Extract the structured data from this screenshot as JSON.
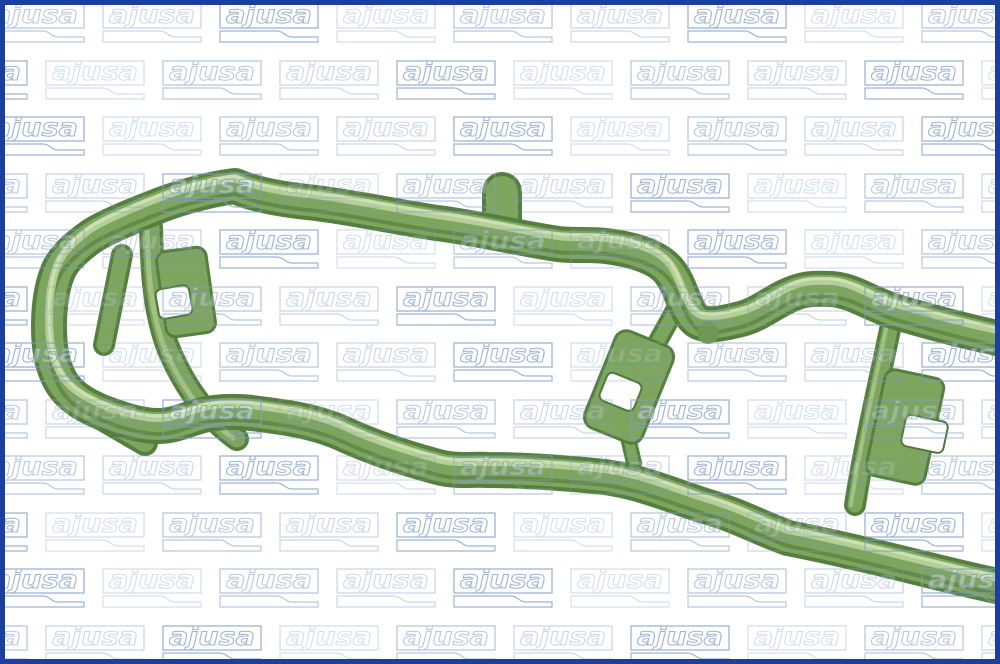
{
  "canvas": {
    "width": 1000,
    "height": 664,
    "background": "#ffffff"
  },
  "border": {
    "color": "#1a3f9f",
    "width_px": 5
  },
  "watermark": {
    "text": "ajusa",
    "stroke_color": "#7f9cc6",
    "letter_fill": "rgba(255,255,255,0.45)",
    "tile_width": 100,
    "tile_height": 40,
    "x_period": 117,
    "y_period": 56.5,
    "rows": 12,
    "cols_from": -1,
    "cols_to": 8,
    "even_row_x_offset": -20,
    "odd_row_x_offset": 40,
    "first_row_y": -2,
    "opacities": [
      0.75,
      0.4,
      0.55,
      0.32
    ],
    "box": {
      "x": 1,
      "y": 1,
      "w": 98,
      "h": 24,
      "stroke_w": 1.3
    },
    "swoosh_path": "M1,28 L58,28 C65,28 66,34 73,34 L99,34 L99,39 L1,39 Z",
    "text_x": 7,
    "text_y": 20,
    "font_size": 25,
    "text_length": 86
  },
  "gasket": {
    "description": "green molded silicone manifold gasket photographed diagonally, left end loop with inner bars and notched tabs, rails running off the right edge",
    "colors": {
      "base": "#7ea55d",
      "edge_dark": "#567f3f",
      "shadow_dark": "#4a7034",
      "highlight": "#b7d29a",
      "highlight_bright": "#d3e4bd",
      "bar_highlight": "#a6c487",
      "nub": "#6f9854",
      "notch_fill": "#fcfdfc",
      "notch_stroke": "#50783a"
    },
    "paths": {
      "frame": "M1016,338 C975,330 925,317 888,306 C862,297 846,285 826,284 C806,283 796,284 780,292 C764,300 752,310 736,314 C720,318 700,323 691,315 C678,303 677,282 664,266 C652,251 625,244 601,241 C584,239 567,241 553,239 C518,234 472,223 432,218 C396,213 342,201 302,197 C274,194 248,189 230,181 C198,185 165,196 148,203 C115,216 95,225 84,233 C68,245 57,255 52,269 C46,285 44,302 44,321 C44,344 47,358 53,371 C61,389 77,399 96,407 C117,415 136,421 153,421 C172,421 186,412 203,409 C230,404 255,409 283,413 C306,417 324,422 343,431 C372,444 407,455 433,462 C452,467 466,464 483,465 C520,465 560,468 600,472 C640,478 665,490 700,501 C740,513 745,519 783,533 C824,541 858,549 903,560 C940,569 975,578 1016,586",
      "frame_bump": "M75,400 L140,438",
      "bar_long": "M146,222 C147,260 148,300 162,340 C180,385 205,415 232,434",
      "bar_short": "M117,250 L99,340",
      "strut_mid": "M674,297 C664,318 650,340 641,358",
      "strut_mid2": "M622,428 L629,458",
      "strut_right": "M889,305 C877,365 860,435 850,500",
      "top_tab": "M497,213 L497,187"
    },
    "tabs": [
      {
        "x": 156,
        "y": 244,
        "w": 50,
        "h": 86,
        "rx": 10,
        "rotate": "-8 181 287"
      },
      {
        "x": 593,
        "y": 330,
        "w": 62,
        "h": 104,
        "rx": 12,
        "rotate": "22 624 382"
      },
      {
        "x": 870,
        "y": 368,
        "w": 60,
        "h": 108,
        "rx": 10,
        "rotate": "12 900 422"
      }
    ],
    "notches": [
      {
        "x": 152,
        "y": 282,
        "w": 34,
        "h": 30,
        "rx": 6,
        "rotate": "-10 169 297"
      },
      {
        "x": 597,
        "y": 372,
        "w": 37,
        "h": 30,
        "rx": 6,
        "rotate": "22 616 387"
      },
      {
        "x": 898,
        "y": 413,
        "w": 43,
        "h": 32,
        "rx": 6,
        "rotate": "12 920 429"
      }
    ],
    "nub": {
      "cx": 703,
      "cy": 328,
      "r": 11
    }
  }
}
